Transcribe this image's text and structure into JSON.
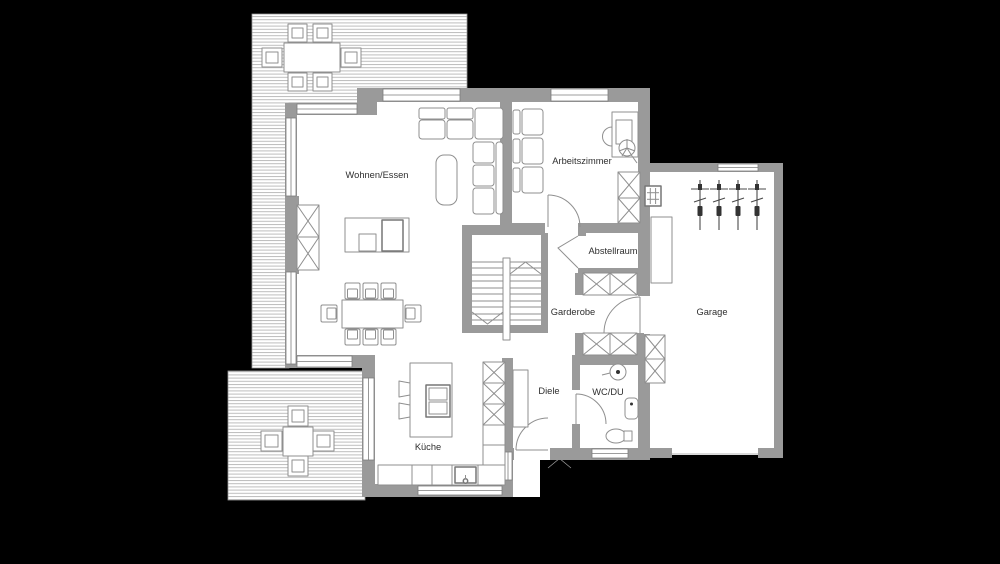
{
  "diagram": {
    "type": "architectural-floor-plan",
    "background_color": "#000000",
    "wall_color": "#9a9a9a",
    "floor_color": "#ffffff",
    "line_color": "#8f8f8f",
    "label_color": "#2e2e2e",
    "rooms": {
      "wohnen_essen": {
        "label": "Wohnen/Essen"
      },
      "arbeitszimmer": {
        "label": "Arbeitszimmer"
      },
      "abstellraum": {
        "label": "Abstellraum"
      },
      "garderobe": {
        "label": "Garderobe"
      },
      "diele": {
        "label": "Diele"
      },
      "kueche": {
        "label": "Küche"
      },
      "wc_du": {
        "label": "WC/DU"
      },
      "garage": {
        "label": "Garage"
      }
    },
    "symbols": {
      "staircase": "U-shaped stair, two flights with direction arrows",
      "fireplace": "cross-hatched chimney block on living room west wall",
      "corner_sofa": "L-shaped sofa with coffee table",
      "dining_table": "table with 8 chairs",
      "kitchen_island": "island with cooktop and 2 stools",
      "sink": "counter sink with faucet",
      "shower": "shower-head circle symbol",
      "toilet": "WC bowl with cistern",
      "washbasin": "rounded basin on wall",
      "desk_chair": "swivel chair star symbol",
      "bicycles": "4 bicycles parked in garage",
      "wardrobes": "cross-hatched closet boxes",
      "terrace_decking": "horizontal plank hatching"
    },
    "visible_counts": {
      "bicycles_in_garage": 4,
      "dining_chairs": 8,
      "terrace_top_chairs": 6,
      "terrace_bottom_chairs": 4
    }
  }
}
